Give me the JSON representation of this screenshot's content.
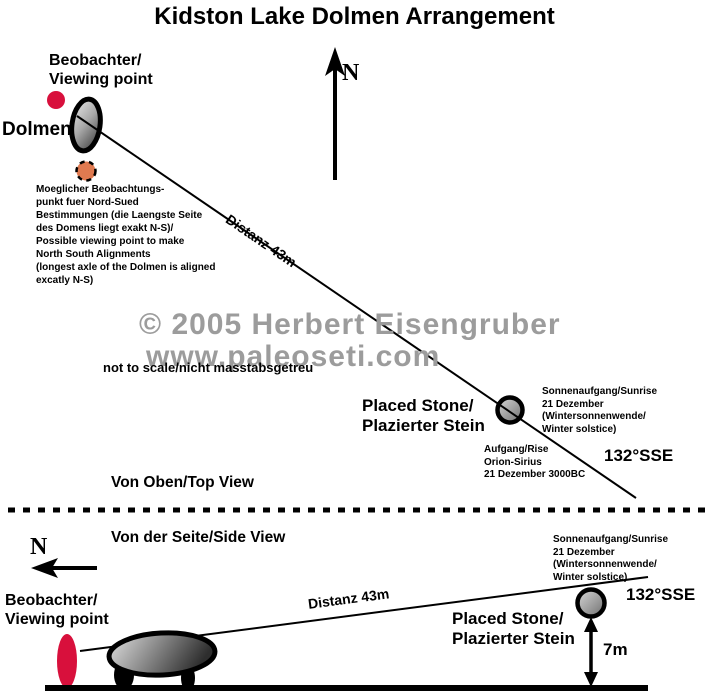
{
  "title": "Kidston Lake Dolmen Arrangement",
  "watermark": {
    "line1": "© 2005 Herbert Eisengruber",
    "line2": "www.paleoseti.com"
  },
  "top_view": {
    "view_label": "Von Oben/Top View",
    "compass_label": "N",
    "observer_label": "Beobachter/\nViewing point",
    "dolmen_label": "Dolmen",
    "alt_viewpoint_note": "Moeglicher Beobachtungs-\npunkt  fuer Nord-Sued\nBestimmungen (die Laengste Seite\ndes Domens liegt exakt N-S)/\nPossible viewing point to make\nNorth South Alignments\n(longest axle of the Dolmen is aligned\nexcatly N-S)",
    "distance_label": "Distanz 43m",
    "scale_note": "not to scale/nicht masstabsgetreu",
    "placed_stone_label": "Placed Stone/\nPlazierter Stein",
    "sunrise_note": "Sonnenaufgang/Sunrise\n21 Dezember (Wintersonnenwende/\nWinter solstice)",
    "orion_note": "Aufgang/Rise\nOrion-Sirius\n21 Dezember 3000BC",
    "azimuth_label": "132°SSE"
  },
  "side_view": {
    "view_label": "Von der Seite/Side View",
    "compass_label": "N",
    "observer_label": "Beobachter/\nViewing point",
    "distance_label": "Distanz 43m",
    "sunrise_note": "Sonnenaufgang/Sunrise\n21 Dezember (Wintersonnenwende/\nWinter solstice)",
    "azimuth_label": "132°SSE",
    "placed_stone_label": "Placed Stone/\nPlazierter Stein",
    "stone_height_label": "7m"
  },
  "colors": {
    "observer_red": "#d8103c",
    "alt_viewpoint_orange": "#e07a50",
    "watermark_gray": "#9c9c9c",
    "ink": "#000000"
  }
}
